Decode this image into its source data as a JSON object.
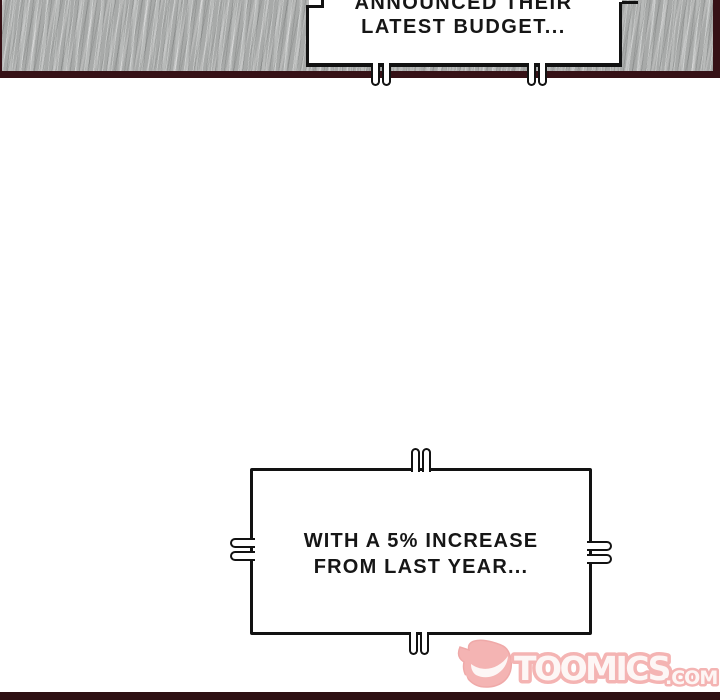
{
  "comic": {
    "top_bubble": {
      "line1": "ANNOUNCED THEIR",
      "line2": "LATEST BUDGET..."
    },
    "bottom_bubble": {
      "line1": "WITH A 5% INCREASE",
      "line2": "FROM LAST YEAR..."
    },
    "watermark": {
      "brand": "TOOMICS",
      "domain": ".COM"
    },
    "colors": {
      "panel_border": "#361116",
      "panel_texture_base": "#a8aaa9",
      "bubble_outline": "#121212",
      "text": "#161616",
      "watermark_pink": "#f2a2a1",
      "watermark_fill": "#fdf5f3",
      "footer_bar": "#2e1013"
    }
  }
}
